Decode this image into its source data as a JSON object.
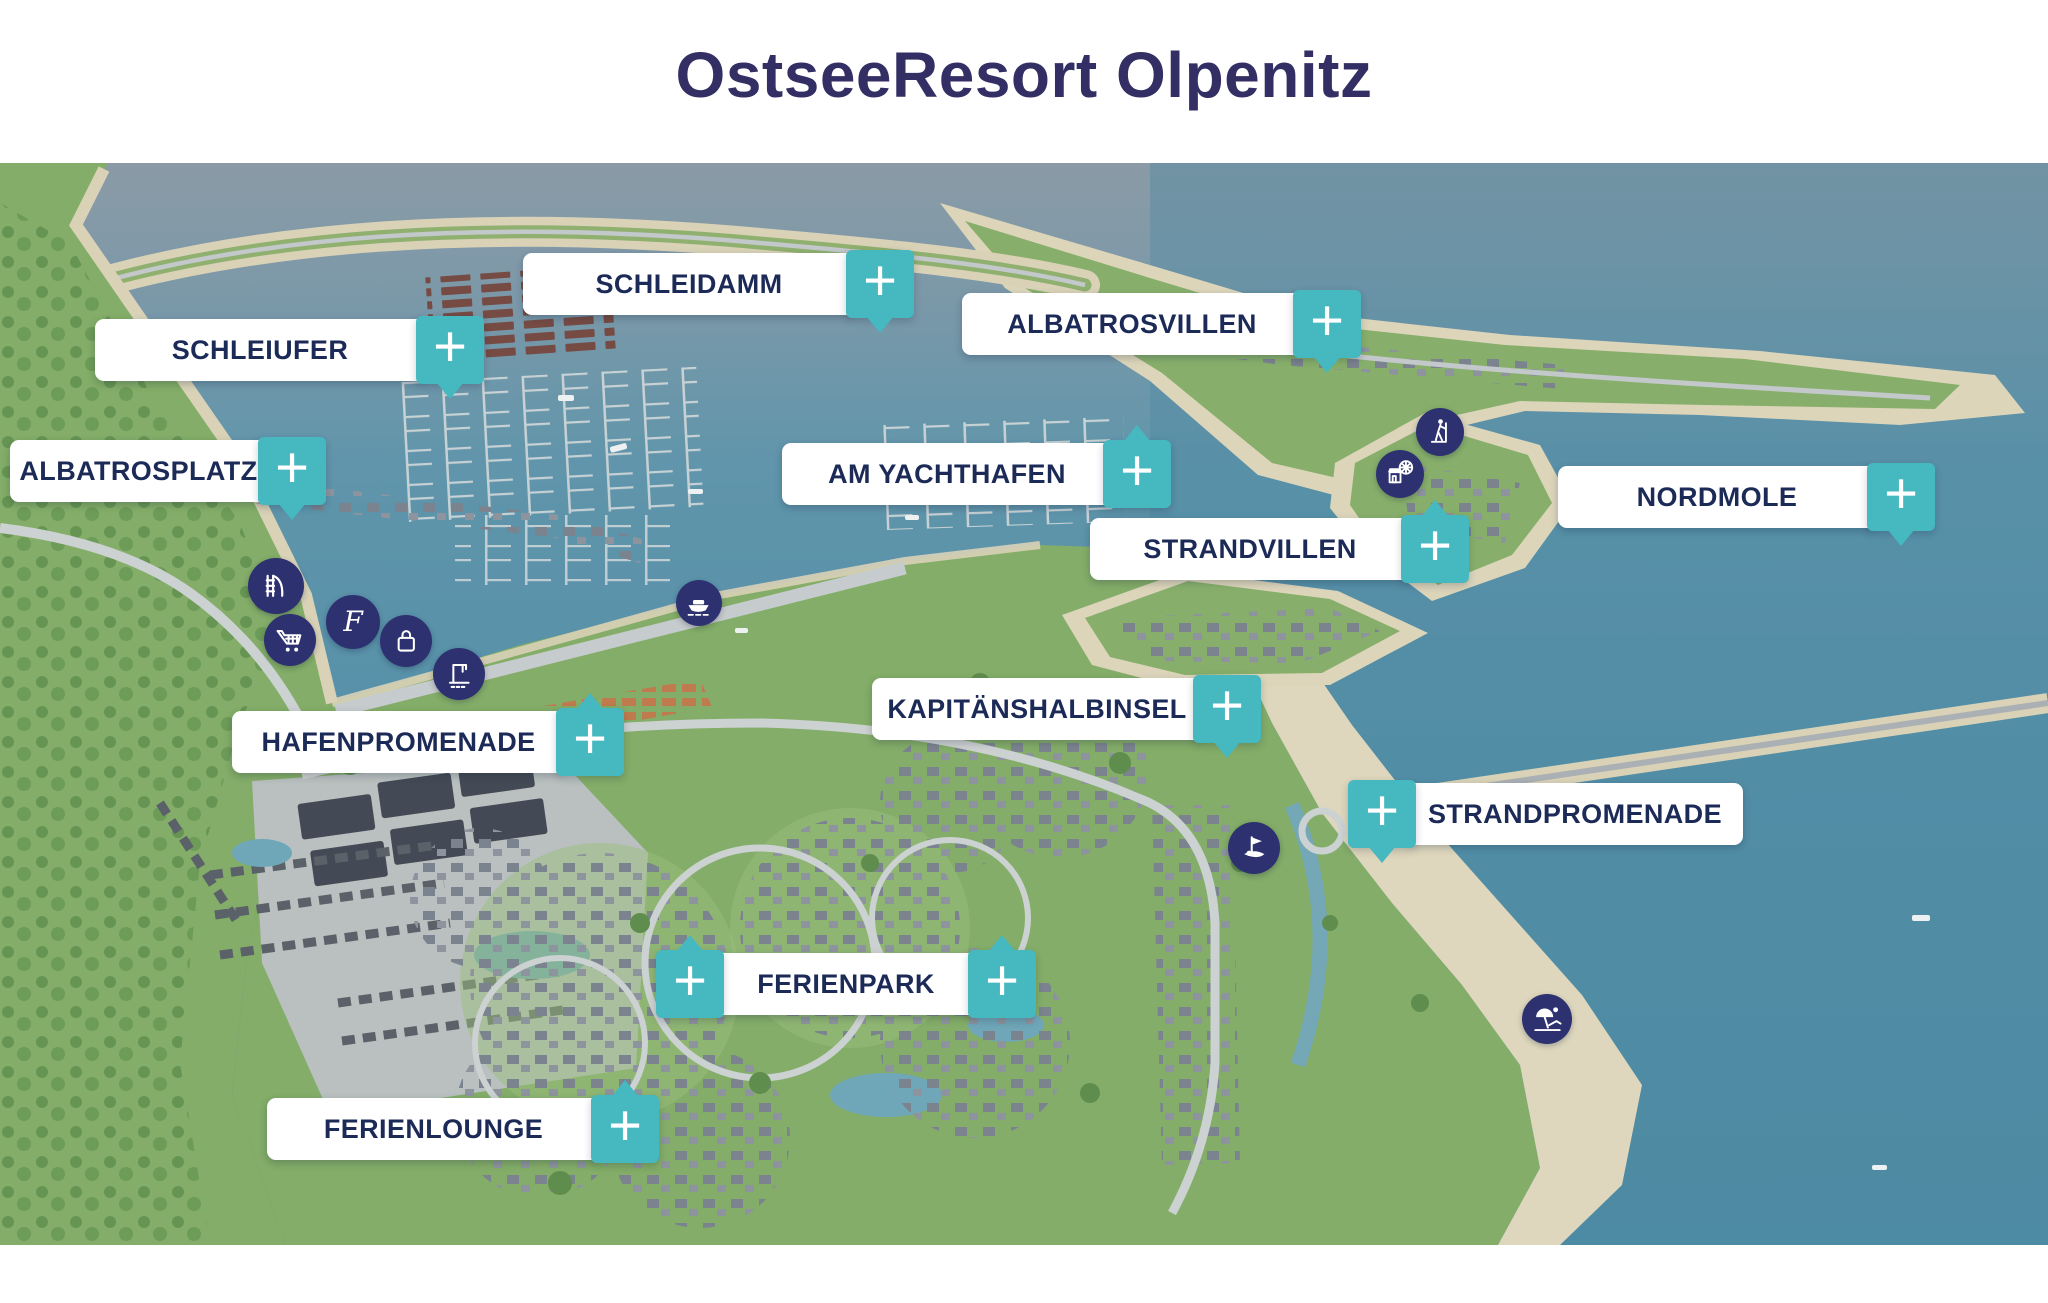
{
  "title": "OstseeResort Olpenitz",
  "theme": {
    "accent_teal": "#45b8c0",
    "label_text_navy": "#1c2a57",
    "title_navy": "#332e63",
    "poi_circle_navy": "#2d3170"
  },
  "map": {
    "plus": "+",
    "areas": [
      {
        "id": "schleidamm",
        "label": "SCHLEIDAMM"
      },
      {
        "id": "schleiufer",
        "label": "SCHLEIUFER"
      },
      {
        "id": "albatrosvillen",
        "label": "ALBATROSVILLEN"
      },
      {
        "id": "albatrosplatz",
        "label": "ALBATROSPLATZ"
      },
      {
        "id": "am-yachthafen",
        "label": "AM YACHTHAFEN"
      },
      {
        "id": "nordmole",
        "label": "NORDMOLE"
      },
      {
        "id": "strandvillen",
        "label": "STRANDVILLEN"
      },
      {
        "id": "kapitaenshalbinsel",
        "label": "KAPITÄNSHALBINSEL"
      },
      {
        "id": "hafenpromenade",
        "label": "HAFENPROMENADE"
      },
      {
        "id": "strandpromenade",
        "label": "STRANDPROMENADE"
      },
      {
        "id": "ferienpark",
        "label": "FERIENPARK"
      },
      {
        "id": "ferienlounge",
        "label": "FERIENLOUNGE"
      }
    ],
    "poi_icons": [
      {
        "name": "waterslide-icon"
      },
      {
        "name": "shopping-cart-icon"
      },
      {
        "name": "f-logo-icon",
        "glyph": "F"
      },
      {
        "name": "shopping-bag-icon"
      },
      {
        "name": "boat-crane-icon"
      },
      {
        "name": "ferry-icon"
      },
      {
        "name": "hiking-icon"
      },
      {
        "name": "leisure-market-icon"
      },
      {
        "name": "golf-icon"
      },
      {
        "name": "beach-icon"
      }
    ]
  }
}
